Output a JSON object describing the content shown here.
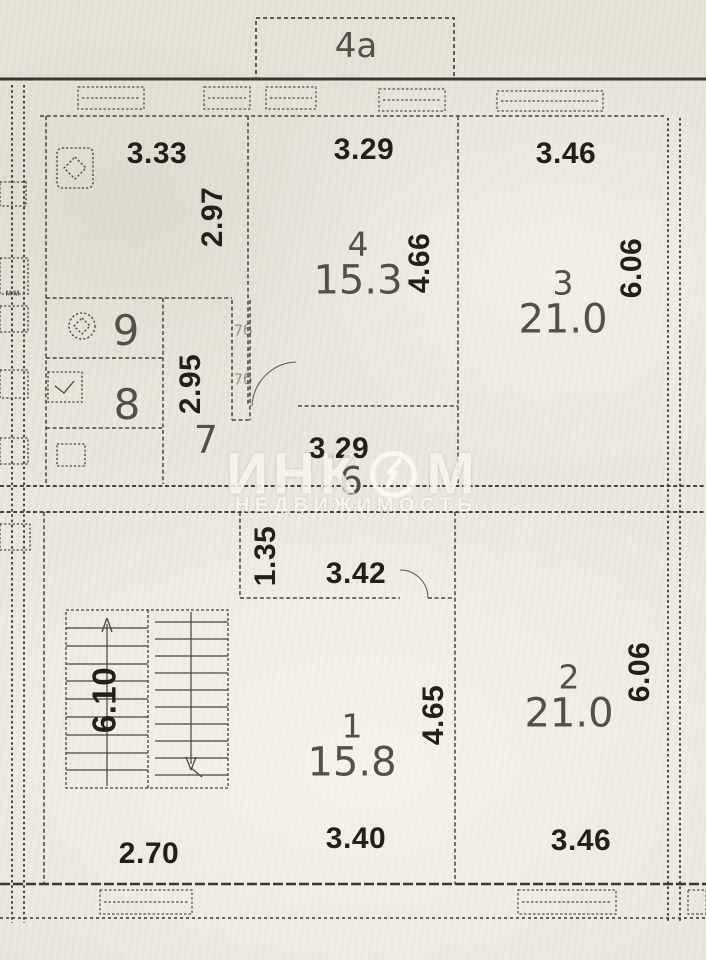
{
  "balcony": {
    "label": "4а"
  },
  "upper_unit": {
    "kitchen": {
      "width": "3.33",
      "depth": "2.97"
    },
    "room4": {
      "number": "4",
      "area": "15.3",
      "width": "3.29",
      "depth": "4.66"
    },
    "room3": {
      "number": "3",
      "area": "21.0",
      "width": "3.46",
      "depth": "6.06"
    },
    "room9": {
      "number": "9"
    },
    "room8": {
      "number": "8"
    },
    "room7": {
      "number": "7"
    },
    "hall6": {
      "number": "6",
      "width": "3.29"
    },
    "inner_depth": "2.95",
    "closet_top": "7б",
    "closet_bottom": "7б",
    "margin_mark": "мм"
  },
  "lower_unit": {
    "entry": {
      "depth": "1.35",
      "width": "3.42"
    },
    "stairwell": {
      "depth": "6.10"
    },
    "room1": {
      "number": "1",
      "area": "15.8",
      "depth": "4.65",
      "width": "3.40"
    },
    "room2": {
      "number": "2",
      "area": "21.0",
      "depth": "6.06",
      "width": "3.46"
    },
    "bottom_left_width": "2.70"
  },
  "watermark": {
    "brand_left": "ИНК",
    "brand_right": "М",
    "subtitle": "НЕДВИЖИМОСТЬ"
  },
  "colors": {
    "paper": "#e8e4d9",
    "ink": "#3c372f",
    "watermark": "rgba(253,251,245,0.8)"
  }
}
